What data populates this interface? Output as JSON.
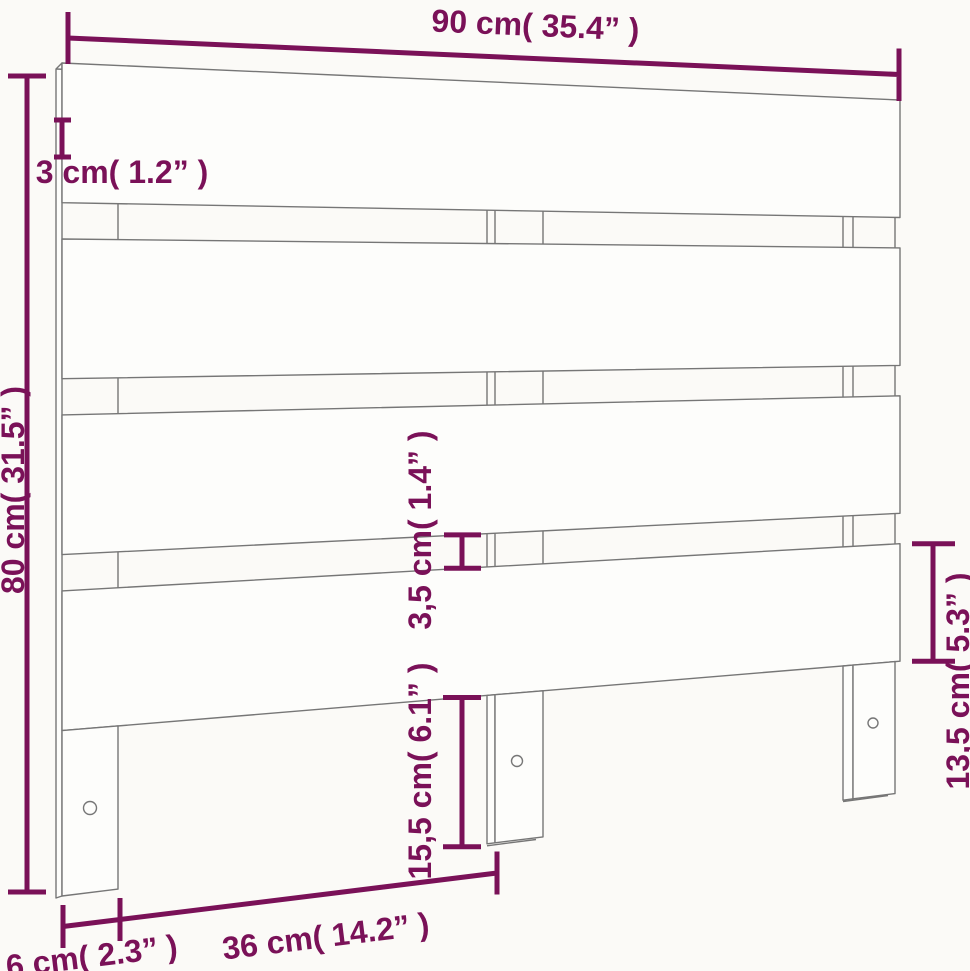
{
  "diagram": {
    "title": "headboard-dimension-diagram",
    "background": "#fbfaf7",
    "drawing_line_color": "#767676",
    "accent_color": "#7a1158",
    "headboard": {
      "slat_count": 4,
      "leg_count": 3,
      "screw_hole_count": 3
    },
    "dimensions": {
      "width": {
        "label": "90 cm( 35.4” )"
      },
      "thickness": {
        "label": "3 cm( 1.2” )"
      },
      "height": {
        "label": "80 cm( 31.5” )"
      },
      "gap": {
        "label": "3,5 cm( 1.4” )"
      },
      "leg_height": {
        "label": "15,5 cm( 6.1” )"
      },
      "slat_height": {
        "label": "13,5 cm( 5.3” )"
      },
      "leg_spacing": {
        "label": "36 cm( 14.2” )"
      },
      "leg_width": {
        "label": "6 cm( 2.3” )"
      }
    }
  }
}
